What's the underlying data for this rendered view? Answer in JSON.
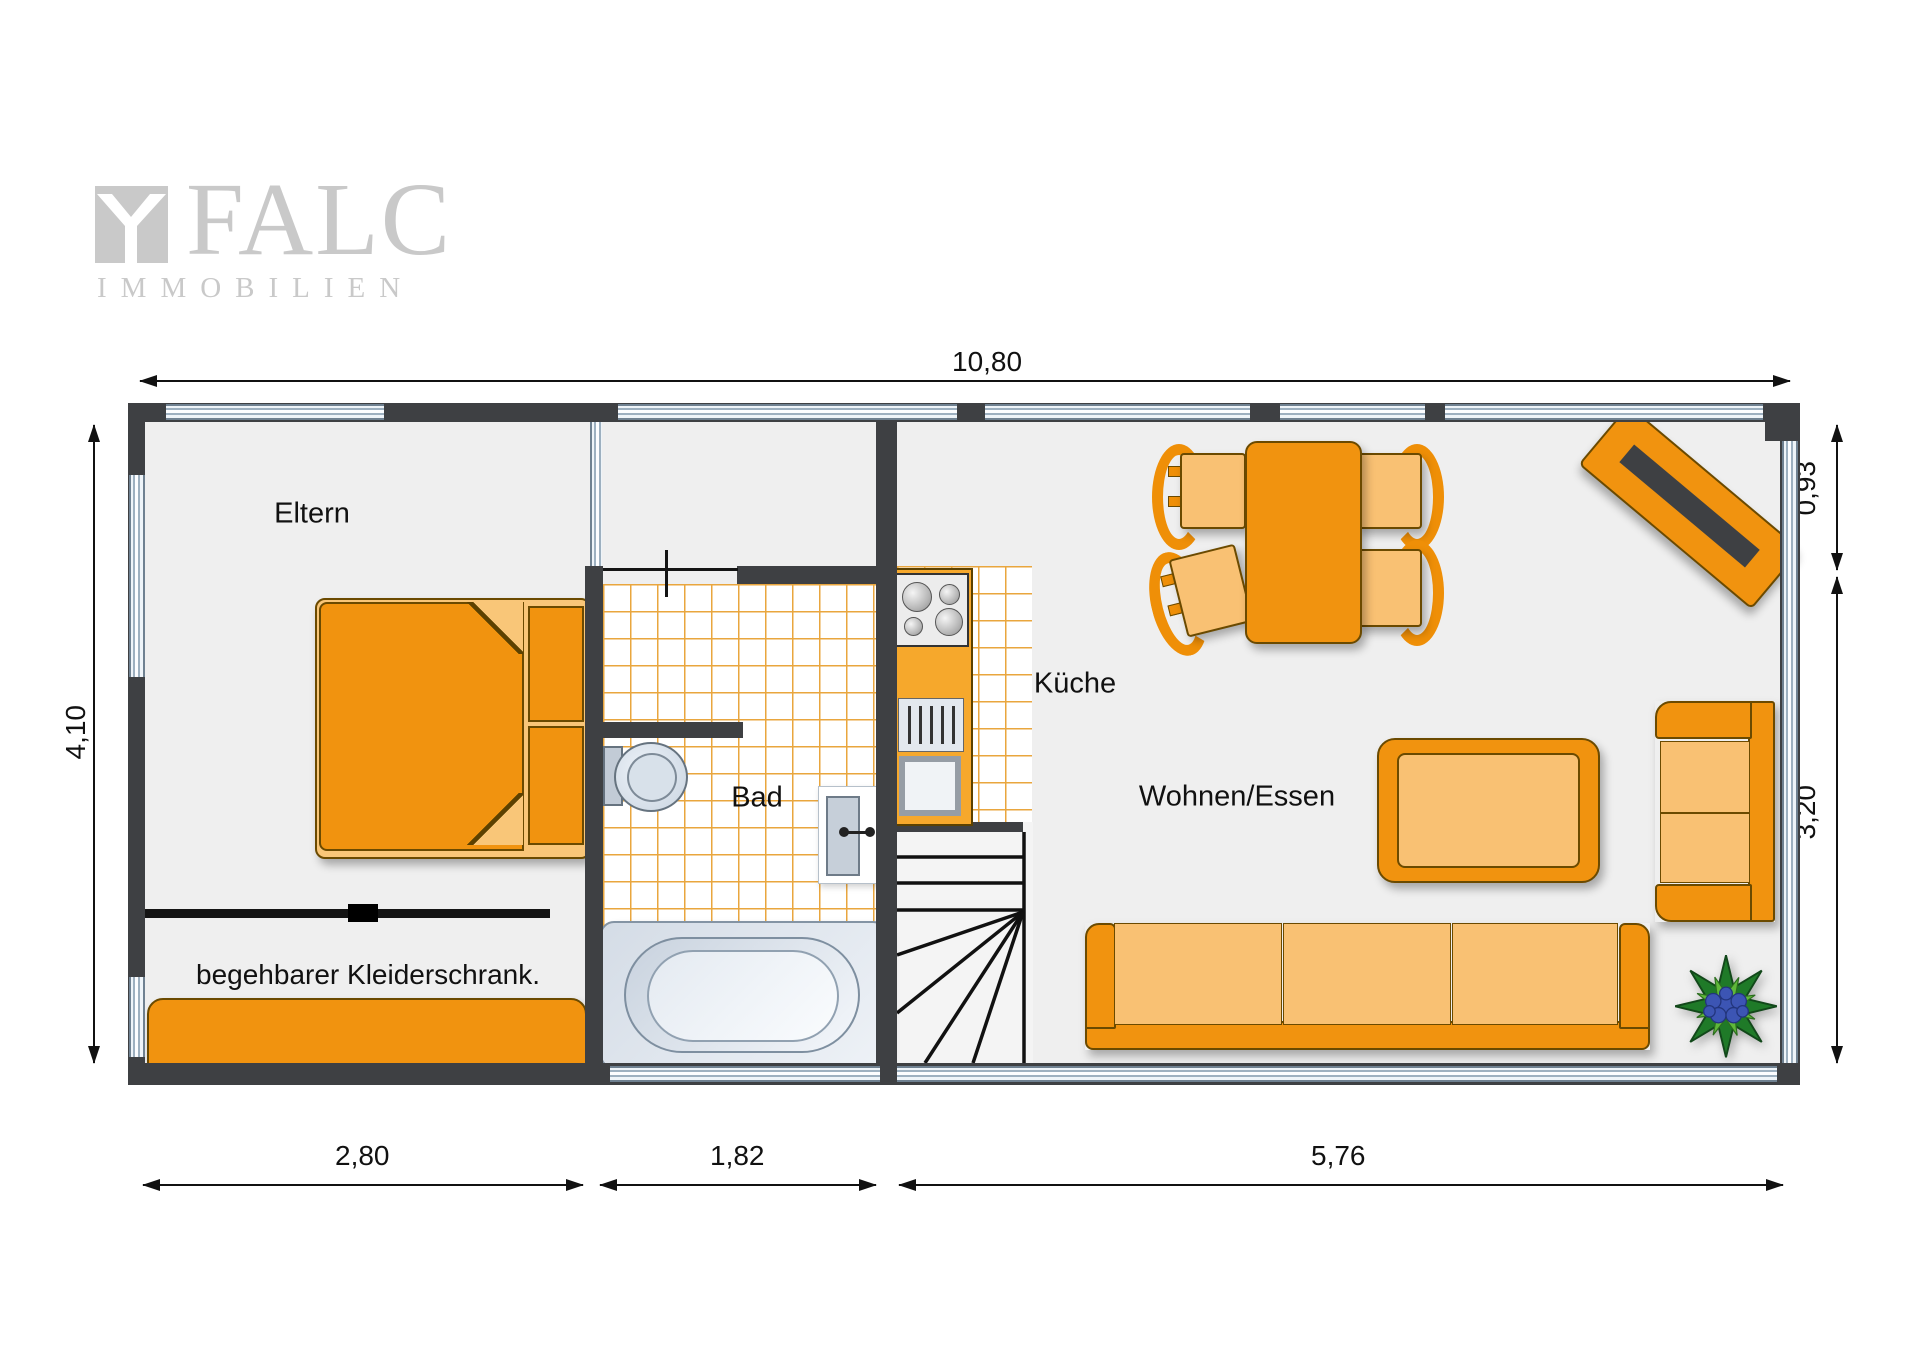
{
  "logo": {
    "brand": "FALC",
    "subtitle": "IMMOBILIEN"
  },
  "rooms": {
    "eltern": "Eltern",
    "kleiderschrank": "begehbarer Kleiderschrank.",
    "bad": "Bad",
    "kueche": "Küche",
    "wohnen": "Wohnen/Essen"
  },
  "dimensions": {
    "total_width": "10,80",
    "left_height": "4,10",
    "right_top": "0,93",
    "right_bottom": "3,20",
    "bottom_left": "2,80",
    "bottom_middle": "1,82",
    "bottom_right": "5,76"
  },
  "colors": {
    "wall": "#3e4043",
    "furniture_orange": "#f1930f",
    "furniture_light": "#f9c173",
    "tile_line": "#e9a63e",
    "floor": "#efefef",
    "window_blue": "#9db0c0",
    "logo_gray": "#c9c9c9",
    "plant_green": "#2e8b2e",
    "plant_blue": "#3c55b4"
  }
}
